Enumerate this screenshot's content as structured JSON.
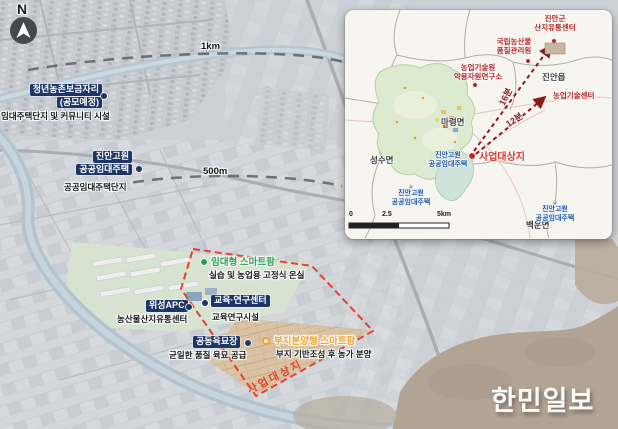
{
  "colors": {
    "navy": "#1d3667",
    "green": "#28a24c",
    "orange": "#f2a12e",
    "site-red": "#e8402a",
    "poi-red": "#b32424",
    "blue": "#1a56a8",
    "route-red": "#8b1a1a"
  },
  "compass": {
    "north": "N"
  },
  "main_map": {
    "distances": {
      "d1km": "1km",
      "d500m": "500m"
    },
    "markers": {
      "youth_housing": {
        "line1": "청년농촌보금자리",
        "line2": "(공모예정)",
        "sub": "임대주택단지 및 커뮤니티 시설"
      },
      "gowon_housing": {
        "line1": "진안고원",
        "line2": "공공임대주택",
        "sub": "공공임대주택단지"
      },
      "rental_smartfarm": {
        "title": "임대형 스마트팜",
        "sub": "실습 및 농업용 고정식 온실"
      },
      "satellite_apc": {
        "title": "위성APC",
        "sub": "농산물산지유통센터"
      },
      "edu_research_center": {
        "title": "교육·연구센터",
        "sub": "교육연구시설"
      },
      "joint_nursery": {
        "title": "공동육묘장",
        "sub": "균일한 품질 육묘 공급"
      },
      "lot_sale_smartfarm": {
        "title": "부지분양형 스마트팜",
        "sub": "부지 기반조성 후 농가 분양"
      }
    },
    "site_boundary_label": "사업대상지"
  },
  "inset_map": {
    "pois": {
      "sanji_center": {
        "line1": "진안군",
        "line2": "산지유통센터"
      },
      "quality_agency": {
        "line1": "국립농산물",
        "line2": "품질관리원"
      },
      "herb_institute": {
        "line1": "농업기술원",
        "line2": "약용자원연구소"
      },
      "agri_tech_center": {
        "title": "농업기술센터"
      }
    },
    "towns": {
      "jinan_eup": "진안읍",
      "maryeong_myeon": "마령면",
      "seongsu_myeon": "성수면",
      "baegun_myeon": "백운면"
    },
    "site": {
      "label": "사업대상지",
      "line1": "진안고원",
      "line2": "공공임대주택"
    },
    "housing_sw": {
      "line1": "진안고원",
      "line2": "공공임대주택"
    },
    "housing_se": {
      "line1": "진안고원",
      "line2": "공공임대주택"
    },
    "routes": {
      "r16": "16분",
      "r12": "12분"
    },
    "scalebar": {
      "zero": "0",
      "mid": "2.5",
      "end": "5km"
    }
  },
  "watermark": "한민일보"
}
